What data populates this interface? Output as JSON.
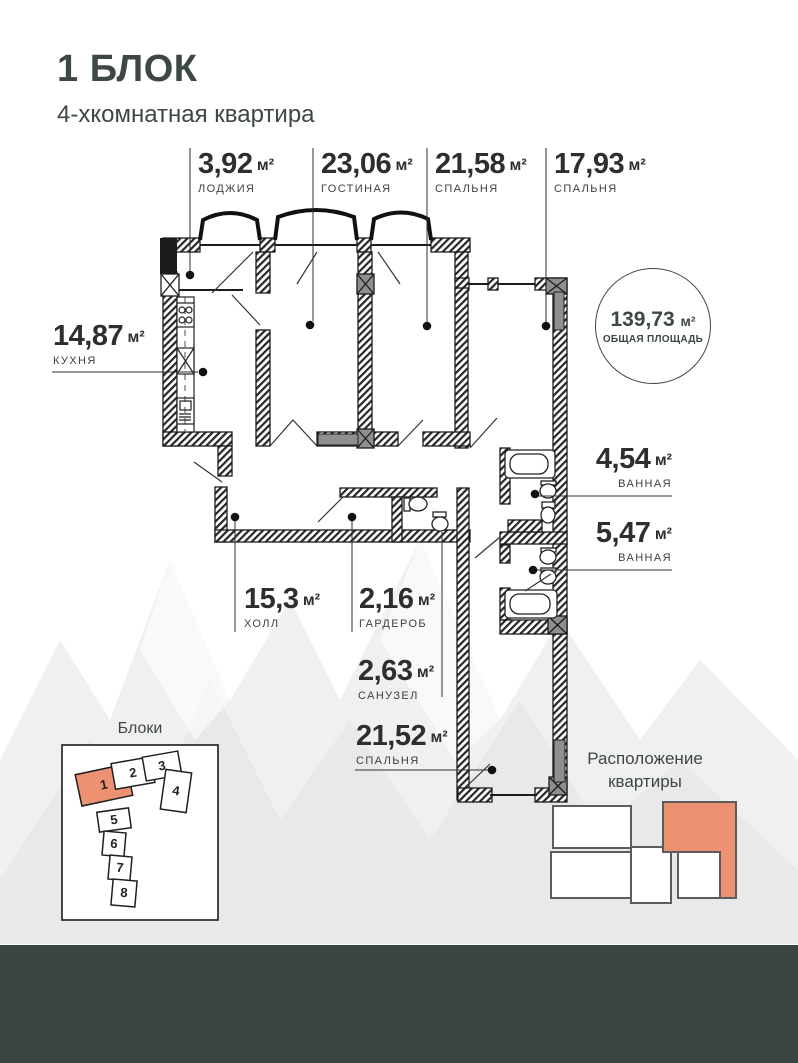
{
  "header": {
    "title": "1 БЛОК",
    "subtitle": "4-хкомнатная квартира"
  },
  "total": {
    "value": "139,73",
    "unit": "м²",
    "label": "ОБЩАЯ ПЛОЩАДЬ"
  },
  "rooms": [
    {
      "area": "3,92",
      "unit": "м²",
      "name": "ЛОДЖИЯ"
    },
    {
      "area": "23,06",
      "unit": "м²",
      "name": "ГОСТИНАЯ"
    },
    {
      "area": "21,58",
      "unit": "м²",
      "name": "СПАЛЬНЯ"
    },
    {
      "area": "17,93",
      "unit": "м²",
      "name": "СПАЛЬНЯ"
    },
    {
      "area": "14,87",
      "unit": "м²",
      "name": "КУХНЯ"
    },
    {
      "area": "4,54",
      "unit": "м²",
      "name": "ВАННАЯ"
    },
    {
      "area": "5,47",
      "unit": "м²",
      "name": "ВАННАЯ"
    },
    {
      "area": "15,3",
      "unit": "м²",
      "name": "ХОЛЛ"
    },
    {
      "area": "2,16",
      "unit": "м²",
      "name": "ГАРДЕРОБ"
    },
    {
      "area": "2,63",
      "unit": "м²",
      "name": "САНУЗЕЛ"
    },
    {
      "area": "21,52",
      "unit": "м²",
      "name": "СПАЛЬНЯ"
    }
  ],
  "blocks": {
    "title": "Блоки",
    "items": [
      "1",
      "2",
      "3",
      "4",
      "5",
      "6",
      "7",
      "8"
    ],
    "active": "1"
  },
  "location": {
    "title_line1": "Расположение",
    "title_line2": "квартиры"
  },
  "colors": {
    "accent": "#ec9273",
    "dark_green": "#3a453f",
    "line": "#2f2f2f"
  }
}
